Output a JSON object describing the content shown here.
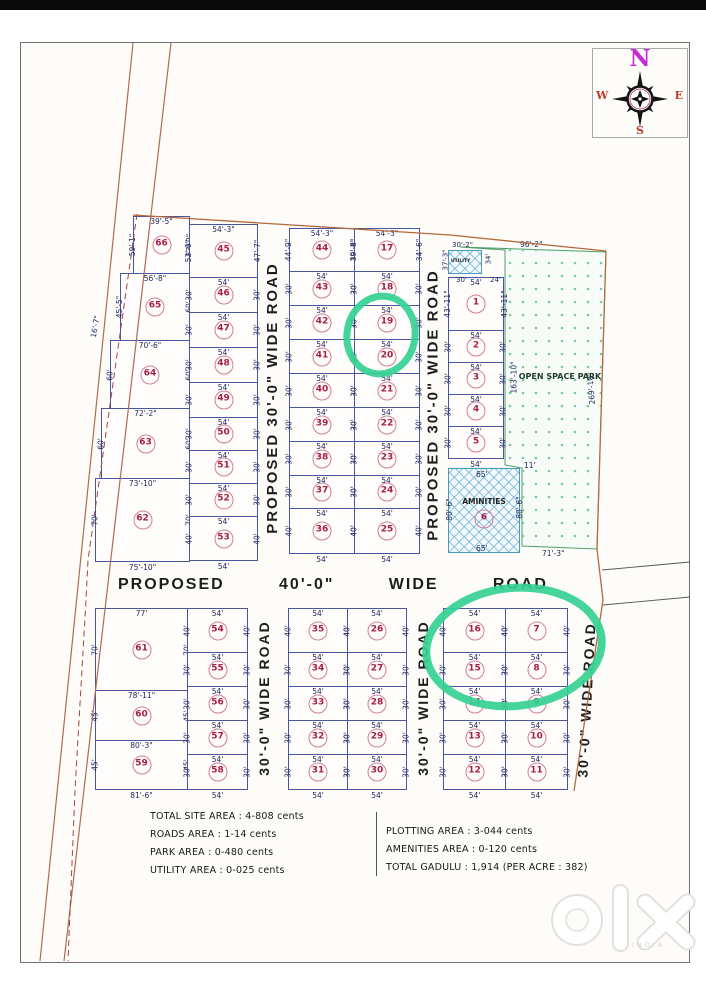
{
  "compass": {
    "n": "N",
    "e": "E",
    "s": "S",
    "w": "W"
  },
  "plan": {
    "columns": [
      {
        "id": "tl-big",
        "plots": [
          {
            "n": "66",
            "t": "39'-5\"",
            "l": "59'-1\"",
            "r": "52'-9\""
          },
          {
            "n": "65",
            "t": "56'-8\"",
            "l": "45'-5\"",
            "r": "60'"
          },
          {
            "n": "64",
            "t": "70'-6\"",
            "l": "60'",
            "r": "60'"
          },
          {
            "n": "63",
            "t": "72'-2\"",
            "l": "60'",
            "r": "60'"
          },
          {
            "n": "62",
            "t": "73'-10\"",
            "l": "70'",
            "r": "70'",
            "b": "75'-10\""
          }
        ]
      },
      {
        "id": "tl-small",
        "plots": [
          {
            "n": "45",
            "t": "54'-3\"",
            "l": "52'-9\"",
            "r": "47'-7\""
          },
          {
            "n": "46",
            "t": "54'",
            "l": "30'",
            "r": "30'"
          },
          {
            "n": "47",
            "t": "54'",
            "l": "30'",
            "r": "30'"
          },
          {
            "n": "48",
            "t": "54'",
            "l": "30'",
            "r": "30'"
          },
          {
            "n": "49",
            "t": "54'",
            "l": "30'",
            "r": "30'"
          },
          {
            "n": "50",
            "t": "54'",
            "l": "30'",
            "r": "30'"
          },
          {
            "n": "51",
            "t": "54'",
            "l": "30'",
            "r": "30'"
          },
          {
            "n": "52",
            "t": "54'",
            "l": "30'",
            "r": "30'"
          },
          {
            "n": "53",
            "t": "54'",
            "l": "40'",
            "r": "40'",
            "b": "54'"
          }
        ]
      },
      {
        "id": "tm-a",
        "plots": [
          {
            "n": "44",
            "t": "54'-3\"",
            "l": "44'-9\"",
            "r": "39'-8\""
          },
          {
            "n": "43",
            "t": "54'",
            "l": "30'",
            "r": "30'"
          },
          {
            "n": "42",
            "t": "54'",
            "l": "30'",
            "r": "30'"
          },
          {
            "n": "41",
            "t": "54'",
            "l": "30'",
            "r": "30'"
          },
          {
            "n": "40",
            "t": "54'",
            "l": "30'",
            "r": "30'"
          },
          {
            "n": "39",
            "t": "54'",
            "l": "30'",
            "r": "30'"
          },
          {
            "n": "38",
            "t": "54'",
            "l": "30'",
            "r": "30'"
          },
          {
            "n": "37",
            "t": "54'",
            "l": "30'",
            "r": "30'"
          },
          {
            "n": "36",
            "t": "54'",
            "l": "40'",
            "r": "40'",
            "b": "54'"
          }
        ]
      },
      {
        "id": "tm-b",
        "plots": [
          {
            "n": "17",
            "t": "54'-3\"",
            "l": "39'-8\"",
            "r": "34'-6\""
          },
          {
            "n": "18",
            "t": "54'",
            "l": "30'",
            "r": "30'"
          },
          {
            "n": "19",
            "t": "54'",
            "l": "30'",
            "r": "30'"
          },
          {
            "n": "20",
            "t": "54'",
            "l": "30'",
            "r": "30'"
          },
          {
            "n": "21",
            "t": "54'",
            "l": "30'",
            "r": "30'"
          },
          {
            "n": "22",
            "t": "54'",
            "l": "30'",
            "r": "30'"
          },
          {
            "n": "23",
            "t": "54'",
            "l": "30'",
            "r": "30'"
          },
          {
            "n": "24",
            "t": "54'",
            "l": "30'",
            "r": "30'"
          },
          {
            "n": "25",
            "t": "54'",
            "l": "40'",
            "r": "40'",
            "b": "54'"
          }
        ]
      },
      {
        "id": "tr",
        "plots": [
          {
            "n": "1",
            "t": "54'",
            "l": "43'-11\"",
            "r": "43'-11\""
          },
          {
            "n": "2",
            "t": "54'",
            "l": "30'",
            "r": "30'"
          },
          {
            "n": "3",
            "t": "54'",
            "l": "30'",
            "r": "30'"
          },
          {
            "n": "4",
            "t": "54'",
            "l": "30'",
            "r": "30'"
          },
          {
            "n": "5",
            "t": "54'",
            "l": "30'",
            "r": "30'",
            "b": "54'"
          }
        ]
      },
      {
        "id": "bl-big",
        "plots": [
          {
            "n": "61",
            "t": "77'",
            "l": "70'",
            "r": "70'"
          },
          {
            "n": "60",
            "t": "78'-11\"",
            "l": "45'",
            "r": "45'"
          },
          {
            "n": "59",
            "t": "80'-3\"",
            "l": "45'",
            "r": "45'",
            "b": "81'-6\""
          }
        ]
      },
      {
        "id": "bl-small",
        "plots": [
          {
            "n": "54",
            "t": "54'",
            "l": "40'",
            "r": "40'"
          },
          {
            "n": "55",
            "t": "54'",
            "l": "30'",
            "r": "30'"
          },
          {
            "n": "56",
            "t": "54'",
            "l": "30'",
            "r": "30'"
          },
          {
            "n": "57",
            "t": "54'",
            "l": "30'",
            "r": "30'"
          },
          {
            "n": "58",
            "t": "54'",
            "l": "30'",
            "r": "30'",
            "b": "54'"
          }
        ]
      },
      {
        "id": "bm-a",
        "plots": [
          {
            "n": "35",
            "t": "54'",
            "l": "40'",
            "r": "40'"
          },
          {
            "n": "34",
            "t": "54'",
            "l": "30'",
            "r": "30'"
          },
          {
            "n": "33",
            "t": "54'",
            "l": "30'",
            "r": "30'"
          },
          {
            "n": "32",
            "t": "54'",
            "l": "30'",
            "r": "30'"
          },
          {
            "n": "31",
            "t": "54'",
            "l": "30'",
            "r": "30'",
            "b": "54'"
          }
        ]
      },
      {
        "id": "bm-b",
        "plots": [
          {
            "n": "26",
            "t": "54'",
            "l": "40'",
            "r": "40'"
          },
          {
            "n": "27",
            "t": "54'",
            "l": "30'",
            "r": "30'"
          },
          {
            "n": "28",
            "t": "54'",
            "l": "30'",
            "r": "30'"
          },
          {
            "n": "29",
            "t": "54'",
            "l": "30'",
            "r": "30'"
          },
          {
            "n": "30",
            "t": "54'",
            "l": "30'",
            "r": "30'",
            "b": "54'"
          }
        ]
      },
      {
        "id": "br-a",
        "plots": [
          {
            "n": "16",
            "t": "54'",
            "l": "40'",
            "r": "40'"
          },
          {
            "n": "15",
            "t": "54'",
            "l": "30'",
            "r": "30'"
          },
          {
            "n": "14",
            "t": "54'",
            "l": "30'",
            "r": "30'"
          },
          {
            "n": "13",
            "t": "54'",
            "l": "30'",
            "r": "30'"
          },
          {
            "n": "12",
            "t": "54'",
            "l": "30'",
            "r": "30'",
            "b": "54'"
          }
        ]
      },
      {
        "id": "br-b",
        "plots": [
          {
            "n": "7",
            "t": "54'",
            "l": "40'",
            "r": "40'"
          },
          {
            "n": "8",
            "t": "54'",
            "l": "30'",
            "r": "30'"
          },
          {
            "n": "9",
            "t": "54'",
            "l": "30'",
            "r": "30'"
          },
          {
            "n": "10",
            "t": "54'",
            "l": "30'",
            "r": "30'"
          },
          {
            "n": "11",
            "t": "54'",
            "l": "30'",
            "r": "30'",
            "b": "54'"
          }
        ]
      }
    ],
    "special_areas": {
      "utility": {
        "label": "UTILITY",
        "t": "30'-2\"",
        "l": "37'-3\"",
        "b": "30'",
        "r": "34'",
        "br": "24'"
      },
      "amenities": {
        "label": "AMINITIES",
        "n": "6",
        "t": "65'",
        "b": "65'",
        "l": "80'-6\"",
        "r": "80'-6\"",
        "corner": "11'"
      },
      "park": {
        "label": "OPEN SPACE PARK",
        "t": "96'-2\"",
        "l": "163'-10\"",
        "r": "269'-10\"",
        "b": "71'-3\""
      }
    },
    "extra_labels": [
      {
        "id": "boundary-dim",
        "text": "16'-7\""
      }
    ],
    "roads": {
      "top_left": "PROPOSED 30'-0\" WIDE ROAD",
      "top_right": "PROPOSED 30'-0\" WIDE ROAD",
      "middle": "PROPOSED 40'-0\" WIDE ROAD",
      "bottom_left": "30'-0\" WIDE ROAD",
      "bottom_mid": "30'-0\" WIDE ROAD",
      "bottom_right": "30'-0\" WIDE ROAD"
    },
    "highlights": [
      {
        "plots": "19, 20"
      },
      {
        "plots": "16, 7, 15, 8"
      }
    ]
  },
  "summary": {
    "left": [
      "TOTAL SITE AREA : 4-808 cents",
      "ROADS AREA : 1-14 cents",
      "PARK  AREA : 0-480 cents",
      "UTILITY AREA : 0-025 cents"
    ],
    "right": [
      "PLOTTING  AREA : 3-044 cents",
      "AMENITIES  AREA : 0-120 cents",
      "TOTAL GADULU : 1,914 (PER ACRE : 382)"
    ]
  },
  "watermark": {
    "brand": "olx",
    "country": "INDIA"
  },
  "colors": {
    "highlight": "#35d191",
    "plot_number": "#a81e44",
    "plot_line": "#4a55a2",
    "boundary": "#b5693c",
    "park_dot": "#7cc9a0",
    "north": "#c42bd4"
  }
}
